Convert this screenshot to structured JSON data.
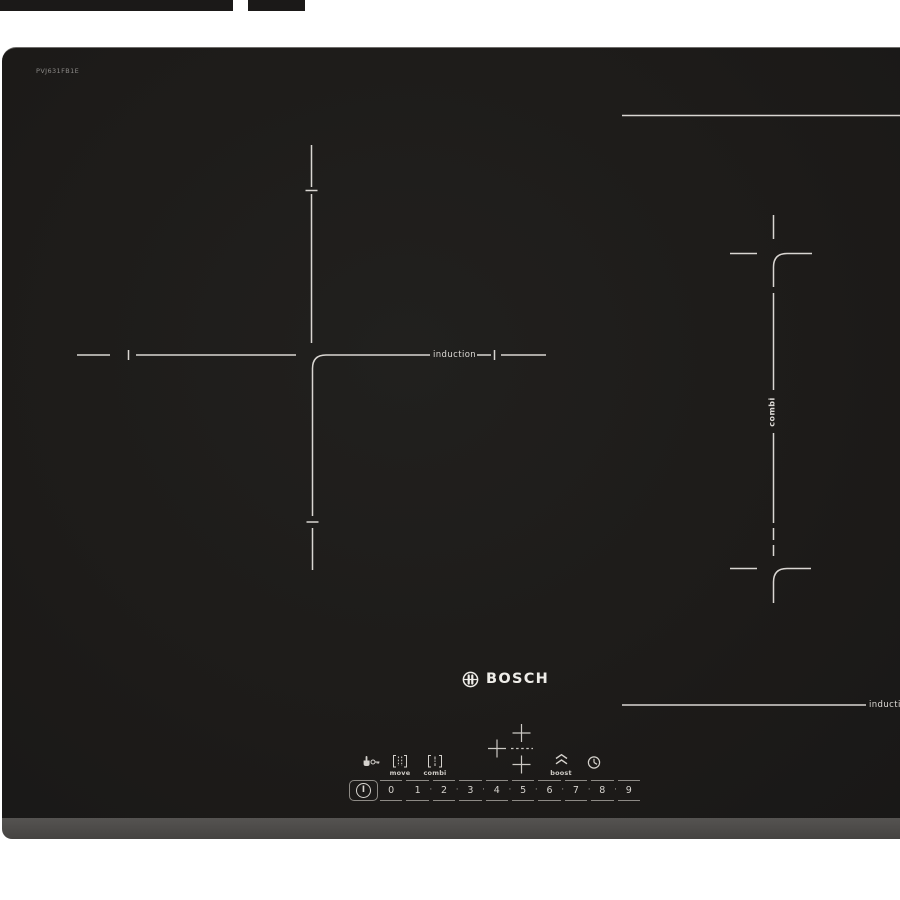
{
  "product": {
    "brand": "BOSCH",
    "model": "PVJ631FB1E"
  },
  "zones": {
    "left_label": "induction",
    "right_vertical_label": "combi",
    "right_bottom_label": "induction"
  },
  "control_panel": {
    "function_labels": {
      "move": "move",
      "combi": "combi",
      "boost": "boost"
    },
    "icons": [
      "child-lock-icon",
      "move-icon",
      "combi-icon",
      "boost-icon",
      "timer-icon",
      "bosch-logo-icon",
      "power-icon",
      "zone-select-crosses"
    ],
    "slider": {
      "power_symbol": "I",
      "numbers": [
        "0",
        "1",
        "2",
        "3",
        "4",
        "5",
        "6",
        "7",
        "8",
        "9"
      ],
      "separator_dot": "·"
    }
  },
  "colors": {
    "background": "#ffffff",
    "glass": "#1d1b19",
    "bezel": "#4c4a48",
    "marking_line": "#d9d6d2",
    "panel_line": "#8d8a85",
    "text_light": "#dcd9d5"
  }
}
